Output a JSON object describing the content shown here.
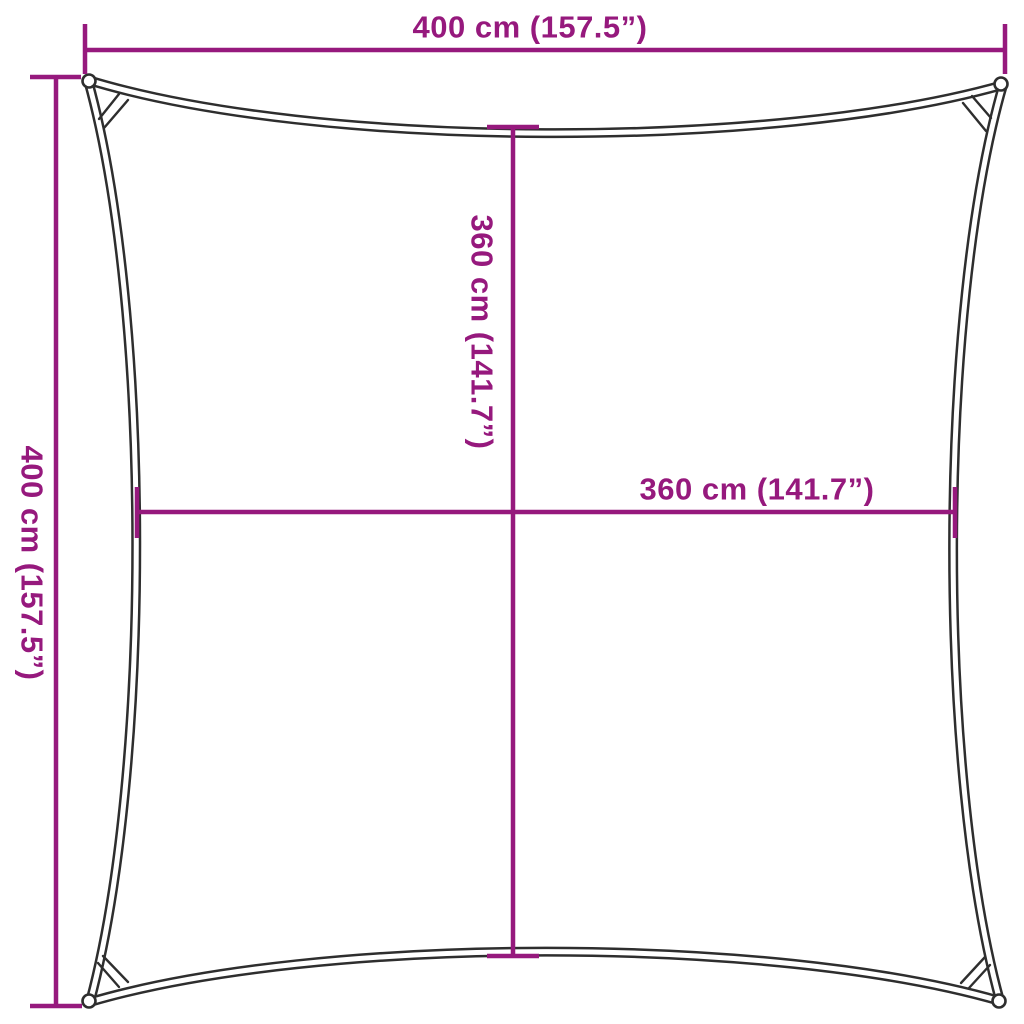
{
  "labels": {
    "top": "400 cm (157.5”)",
    "left": "400 cm (157.5”)",
    "middle_vertical": "360 cm (141.7”)",
    "middle_horizontal": "360 cm (141.7”)"
  },
  "measurements": {
    "top_edge_corner_to_corner": {
      "cm": 400,
      "inches": 157.5
    },
    "left_edge_corner_to_corner": {
      "cm": 400,
      "inches": 157.5
    },
    "middle_vertical_span": {
      "cm": 360,
      "inches": 141.7
    },
    "middle_horizontal_span": {
      "cm": 360,
      "inches": 141.7
    }
  },
  "icons": {
    "corner_grommet": "ring-eyelet"
  },
  "colors": {
    "accent": "#96197D",
    "outline": "#2e2e2e",
    "background": "#ffffff"
  }
}
